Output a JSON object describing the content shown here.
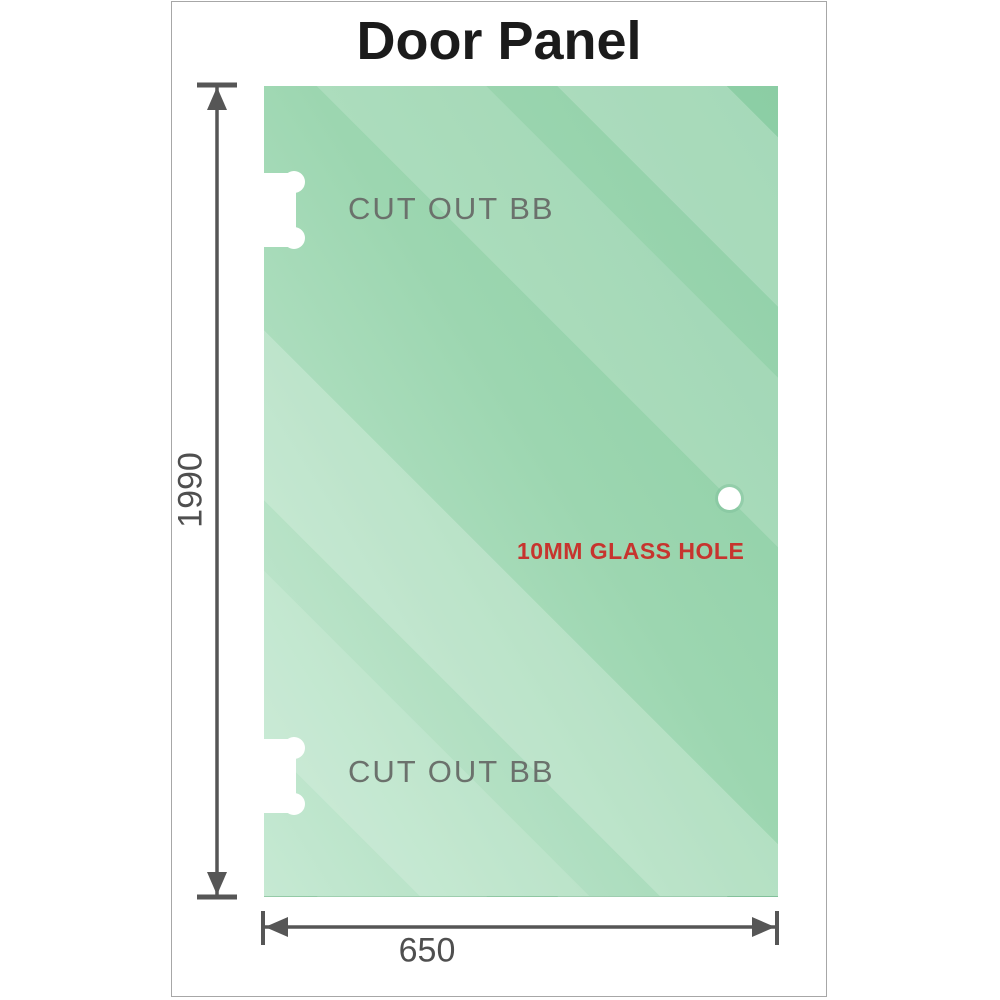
{
  "title": "Door Panel",
  "panel": {
    "cutout_top_label": "CUT OUT BB",
    "cutout_bottom_label": "CUT OUT BB",
    "hole_label": "10MM GLASS HOLE"
  },
  "dimensions": {
    "height": "1990",
    "width": "650"
  },
  "colors": {
    "glass_base": "#8bcda4",
    "glass_light": "#c6e9d3",
    "dimension_gray": "#565656",
    "hole_label_red": "#c7342e",
    "cutout_label_gray": "#6b716c",
    "frame_border": "#a7a7a7"
  }
}
